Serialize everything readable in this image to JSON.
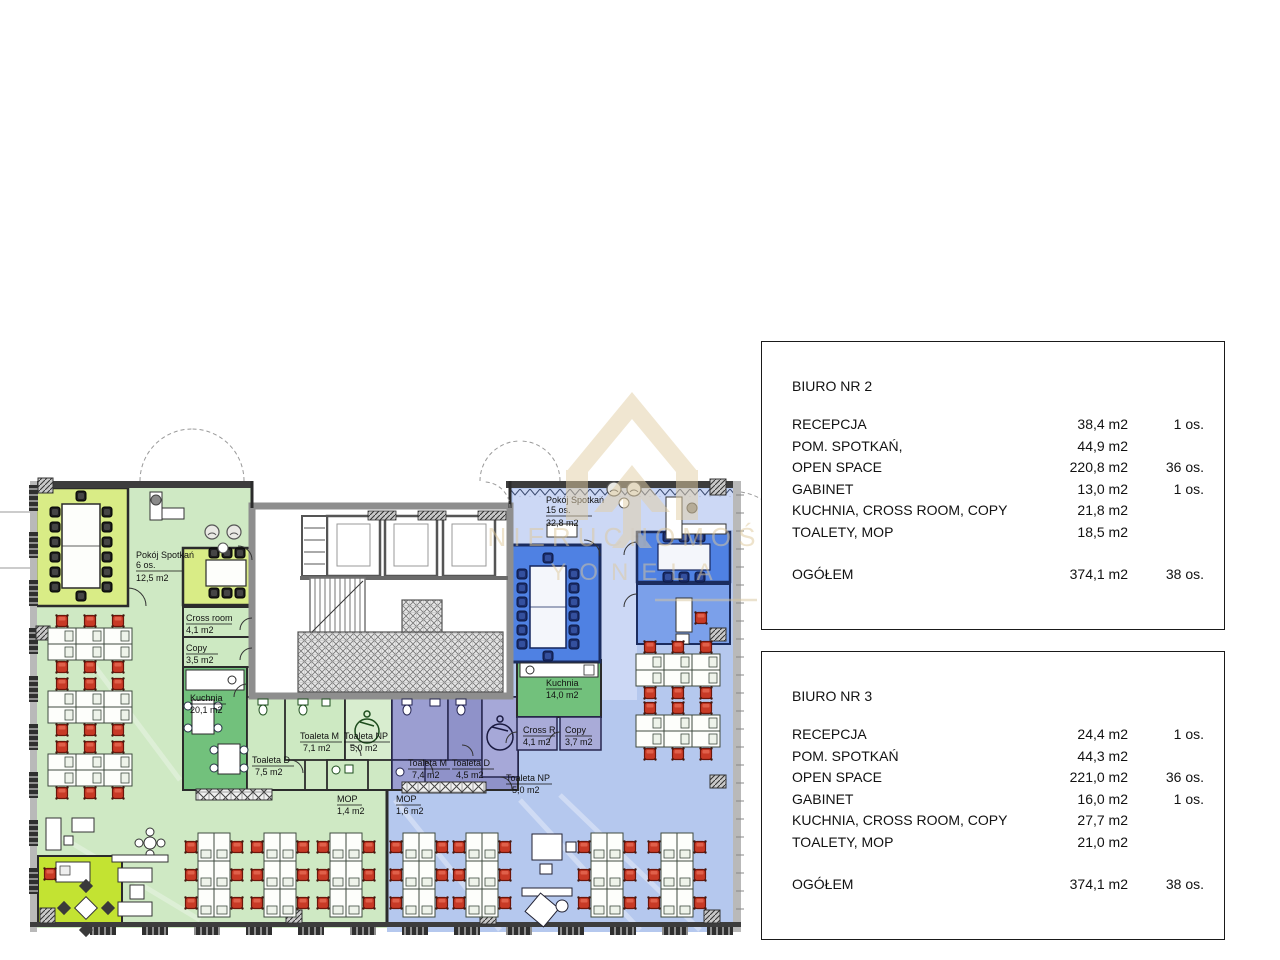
{
  "watermark": {
    "line1": "NIERUCHOMOŚCI",
    "line2": "YONELA"
  },
  "boxes": [
    {
      "title": "BIURO NR 2",
      "rows": [
        {
          "label": "RECEPCJA",
          "area": "38,4 m2",
          "persons": "1 os."
        },
        {
          "label": "POM. SPOTKAŃ,",
          "area": "44,9 m2",
          "persons": ""
        },
        {
          "label": "OPEN SPACE",
          "area": "220,8 m2",
          "persons": "36 os."
        },
        {
          "label": "GABINET",
          "area": "13,0 m2",
          "persons": "1 os."
        },
        {
          "label": "KUCHNIA, CROSS ROOM, COPY",
          "area": "21,8 m2",
          "persons": ""
        },
        {
          "label": "TOALETY, MOP",
          "area": "18,5 m2",
          "persons": ""
        }
      ],
      "total": {
        "label": "OGÓŁEM",
        "area": "374,1 m2",
        "persons": "38 os."
      }
    },
    {
      "title": "BIURO NR 3",
      "rows": [
        {
          "label": "RECEPCJA",
          "area": "24,4 m2",
          "persons": "1 os."
        },
        {
          "label": "POM. SPOTKAŃ",
          "area": "44,3 m2",
          "persons": ""
        },
        {
          "label": "OPEN SPACE",
          "area": "221,0 m2",
          "persons": "36 os."
        },
        {
          "label": "GABINET",
          "area": "16,0 m2",
          "persons": "1 os."
        },
        {
          "label": "KUCHNIA, CROSS ROOM, COPY",
          "area": "27,7 m2",
          "persons": ""
        },
        {
          "label": "TOALETY, MOP",
          "area": "21,0 m2",
          "persons": ""
        }
      ],
      "total": {
        "label": "OGÓŁEM",
        "area": "374,1 m2",
        "persons": "38 os."
      }
    }
  ],
  "plan": {
    "labels": {
      "meeting_left": {
        "l1": "Pokój Spotkań",
        "l2": "6 os.",
        "l3": "12,5 m2"
      },
      "cross_left": {
        "l1": "Cross room",
        "l2": "4,1 m2"
      },
      "copy_left": {
        "l1": "Copy",
        "l2": "3,5 m2"
      },
      "kitchen_left": {
        "l1": "Kuchnia",
        "l2": "20,1 m2"
      },
      "toaleta_d_left": {
        "l1": "Toaleta D",
        "l2": "7,5 m2"
      },
      "toaleta_m_left": {
        "l1": "Toaleta M",
        "l2": "7,1 m2"
      },
      "toaleta_np_left": {
        "l1": "Toaleta NP",
        "l2": "5,0 m2"
      },
      "mop_left": {
        "l1": "MOP",
        "l2": "1,4 m2"
      },
      "meeting_right": {
        "l1": "Pokój Spotkań",
        "l2": "15 os.",
        "l3": "32,8 m2"
      },
      "kitchen_right": {
        "l1": "Kuchnia",
        "l2": "14,0 m2"
      },
      "cross_right": {
        "l1": "Cross R.",
        "l2": "4,1 m2"
      },
      "copy_right": {
        "l1": "Copy",
        "l2": "3,7 m2"
      },
      "toaleta_m_right": {
        "l1": "Toaleta M",
        "l2": "7,4 m2"
      },
      "toaleta_d_right": {
        "l1": "Toaleta D",
        "l2": "4,5 m2"
      },
      "toaleta_np_right": {
        "l1": "Toaleta NP",
        "l2": "5,0 m2"
      },
      "mop_right": {
        "l1": "MOP",
        "l2": "1,6 m2"
      }
    },
    "colors": {
      "green_light": "#cfe9c4",
      "green_room": "#d9ec86",
      "green_bright": "#c3e332",
      "green_kitchen": "#72c17c",
      "blue_light": "#b5c8ee",
      "blue_room": "#4f81e3",
      "blue_gabinet": "#7ba0ea",
      "purple_wc": "#8f92c9",
      "chair_red": "#c83a26",
      "watermark_beige": "#e3cfa5"
    }
  }
}
